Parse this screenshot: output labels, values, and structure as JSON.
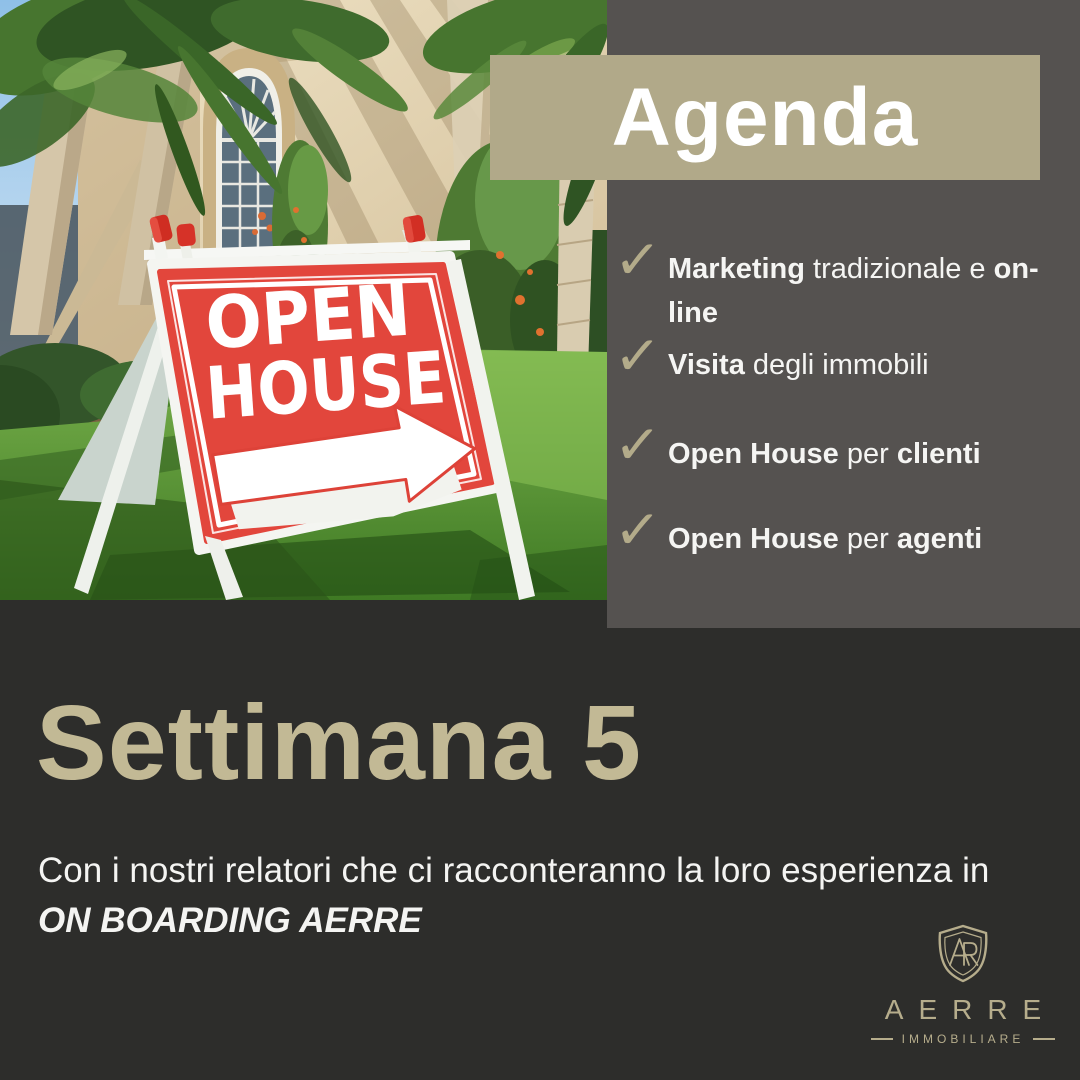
{
  "colors": {
    "accent_tan": "#b1a989",
    "panel_gray": "#555250",
    "bottom_bg": "#2d2d2b",
    "headline_tan": "#c2b995",
    "check_tan": "#b3ab8a",
    "sign_red": "#e2463c",
    "text_light": "#f5f5f3"
  },
  "photo": {
    "alt": "open-house-yard-sign-photo",
    "sign_line1": "OPEN",
    "sign_line2": "HOUSE"
  },
  "agenda": {
    "title": "Agenda",
    "check_icon": "✓",
    "items": [
      {
        "segments": [
          {
            "text": "Marketing",
            "bold": true
          },
          {
            "text": " tradizionale e ",
            "bold": false
          },
          {
            "text": "on-line",
            "bold": true
          }
        ]
      },
      {
        "segments": [
          {
            "text": "Visita",
            "bold": true
          },
          {
            "text": " degli immobili",
            "bold": false
          }
        ]
      },
      {
        "segments": [
          {
            "text": "Open House",
            "bold": true
          },
          {
            "text": " per ",
            "bold": false
          },
          {
            "text": "clienti",
            "bold": true
          }
        ]
      },
      {
        "segments": [
          {
            "text": "Open House",
            "bold": true
          },
          {
            "text": " per ",
            "bold": false
          },
          {
            "text": "agenti",
            "bold": true
          }
        ]
      }
    ]
  },
  "week": {
    "title": "Settimana 5",
    "description_segments": [
      {
        "text": "Con i nostri relatori che ci racconteranno la loro esperienza in ",
        "bold": false,
        "italic": false
      },
      {
        "text": "ON BOARDING AERRE",
        "bold": true,
        "italic": true
      }
    ]
  },
  "logo": {
    "monogram": "AR",
    "name": "AERRE",
    "tagline": "IMMOBILIARE"
  }
}
